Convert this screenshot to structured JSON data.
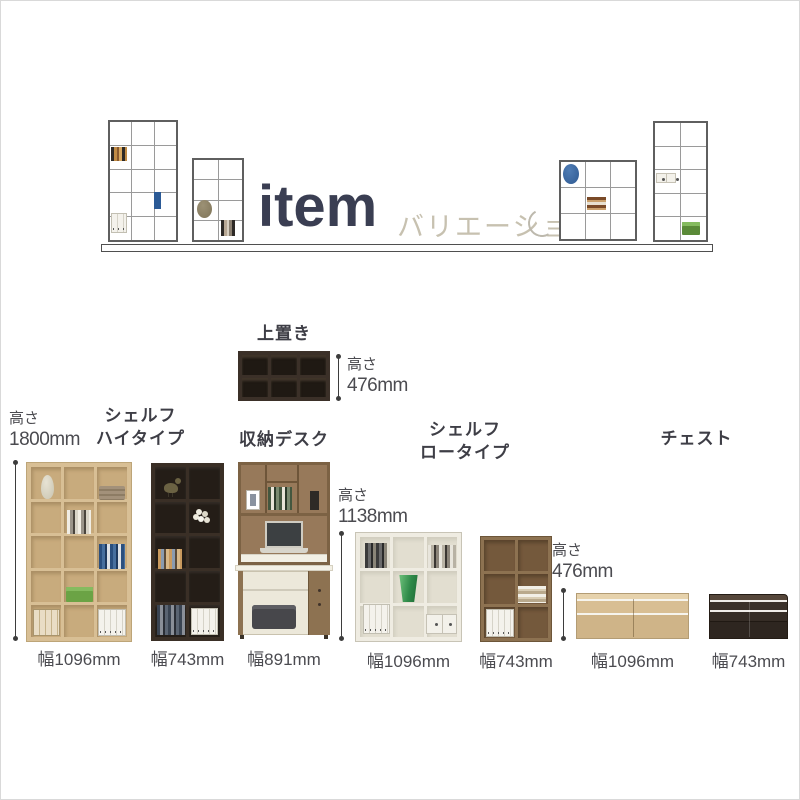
{
  "header": {
    "title": "item",
    "subtitle": "バリエーション"
  },
  "colors": {
    "title_accent": "#3a3e52",
    "subtitle_accent": "#c7c1b0",
    "light_oak": "#d8bf95",
    "dark_brown": "#3b3028",
    "walnut": "#8d7251",
    "white_wood": "#efece2"
  },
  "products": {
    "top_unit": {
      "name": "上置き",
      "height_label": "高さ",
      "height_value": "476mm"
    },
    "shelf_high": {
      "name_line1": "シェルフ",
      "name_line2": "ハイタイプ",
      "height_label": "高さ",
      "height_value": "1800mm",
      "variants": [
        {
          "width": "幅1096mm"
        },
        {
          "width": "幅743mm"
        }
      ]
    },
    "desk": {
      "name": "収納デスク",
      "width": "幅891mm"
    },
    "shelf_low": {
      "name_line1": "シェルフ",
      "name_line2": "ロータイプ",
      "height_label": "高さ",
      "height_value": "1138mm",
      "variants": [
        {
          "width": "幅1096mm"
        },
        {
          "width": "幅743mm"
        }
      ]
    },
    "chest": {
      "name": "チェスト",
      "height_label": "高さ",
      "height_value": "476mm",
      "variants": [
        {
          "width": "幅1096mm"
        },
        {
          "width": "幅743mm"
        }
      ]
    }
  }
}
